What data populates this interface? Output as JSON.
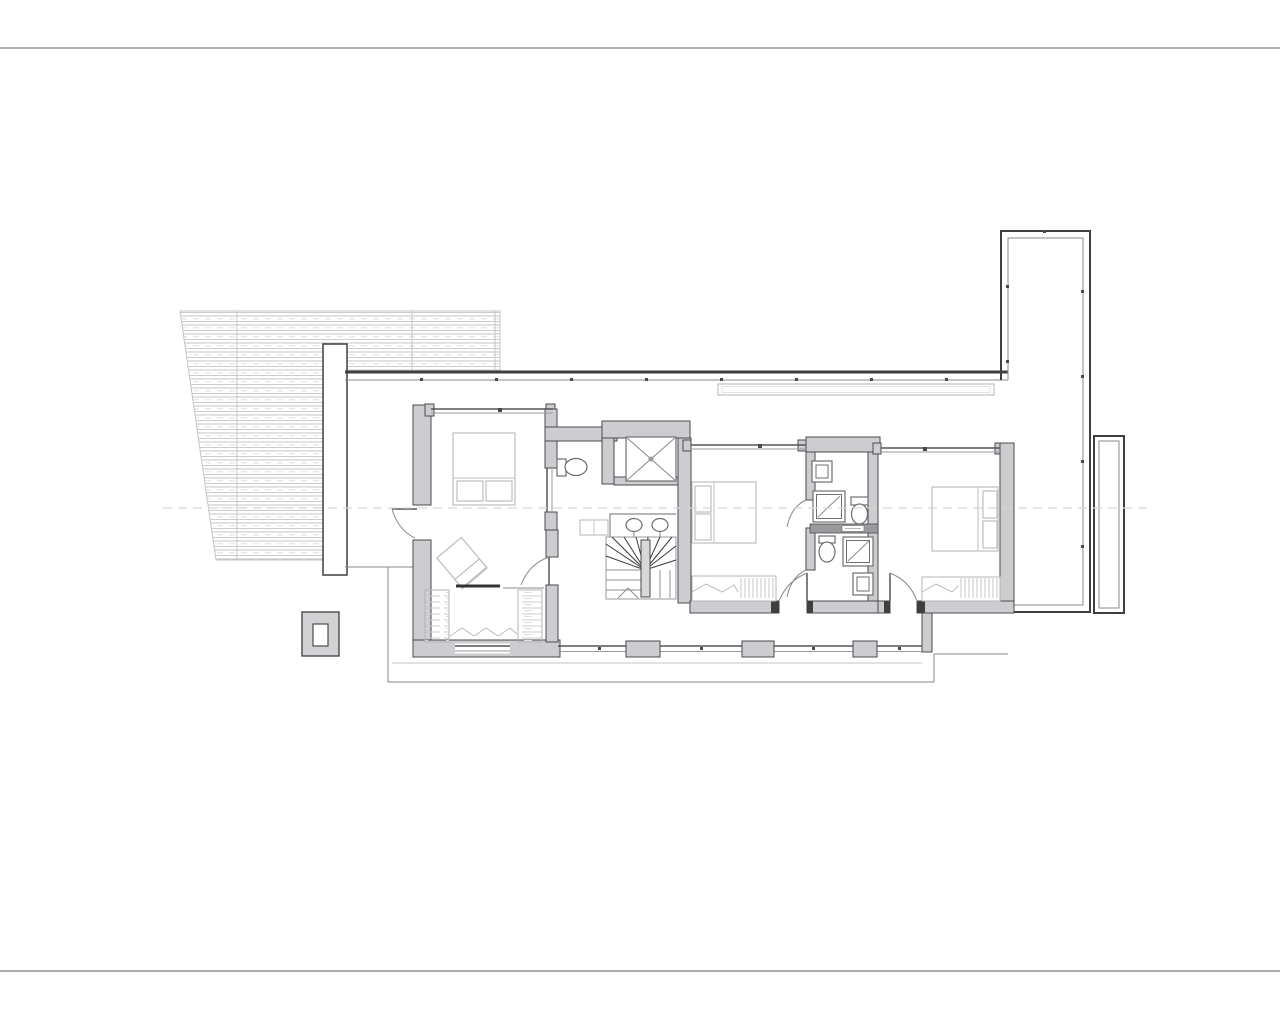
{
  "document": {
    "kind": "architectural floor plan drawing sheet",
    "page": {
      "width": 1280,
      "height": 1024,
      "background": "#ffffff"
    },
    "visible_text": [],
    "annotations": {
      "horizontal_centerline": "dashed",
      "page_rules": "top and bottom horizontal border lines"
    }
  },
  "colors": {
    "bg": "#ffffff",
    "page_rule": "#aeaeae",
    "centerline": "#d6d6d6",
    "wall_fill": "#cdcdd1",
    "wall_edge": "#4a4a4a",
    "line_dark": "#3f3f3f",
    "line_medium": "#8a8a8a",
    "line_light": "#c4c4c4",
    "furniture": "#bdbdbd",
    "fixture": "#6e6e6e",
    "hatch": "#c9c9c9"
  },
  "plan": {
    "rooms": [
      "pergola-louvre-roof",
      "master-bedroom",
      "dressing-room",
      "bathroom-master",
      "vanity-hall",
      "elevator-shaft",
      "winder-stair",
      "bedroom-2",
      "bathroom-upper",
      "bathroom-lower",
      "bedroom-3",
      "south-corridor",
      "north-terrace",
      "east-terrace",
      "south-terrace"
    ],
    "fixtures": [
      "bed-master",
      "bed-2",
      "bed-3",
      "pillows",
      "wardrobe-left",
      "wardrobe-right",
      "wardrobe-bedroom-2",
      "wardrobe-bedroom-3",
      "lounge-chair",
      "chimney",
      "toilet-master",
      "toilet-upper",
      "toilet-lower",
      "double-sink-vanity",
      "washbasin-upper",
      "washbasin-lower",
      "shower-upper",
      "shower-lower",
      "planter",
      "parapet-railing",
      "glazed-south-wall",
      "doors-swing"
    ]
  }
}
